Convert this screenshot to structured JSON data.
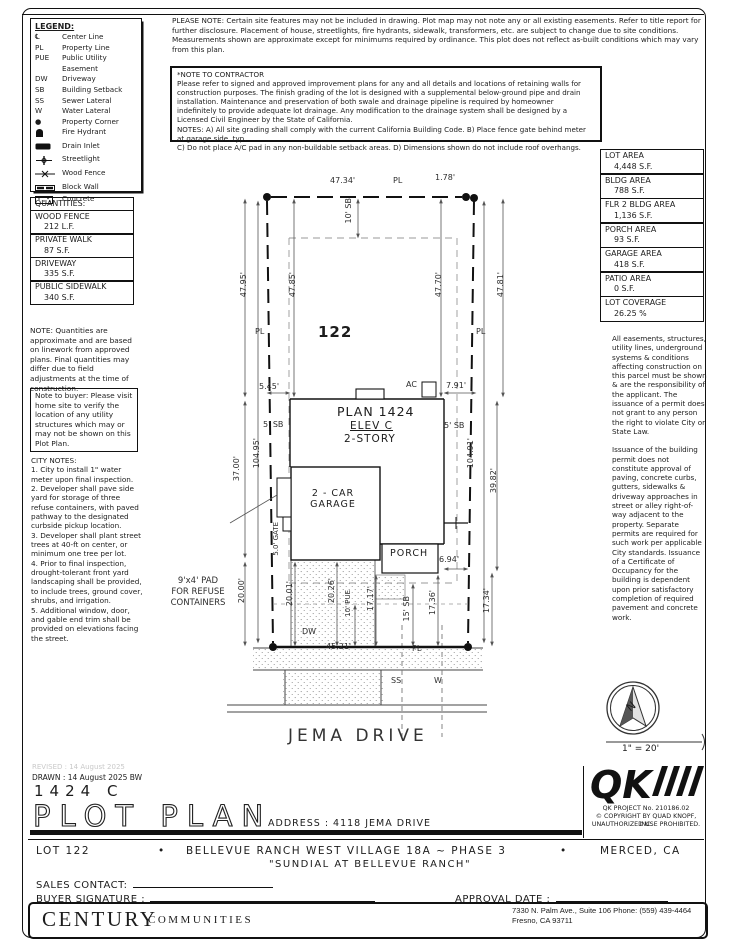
{
  "legend": {
    "title": "LEGEND:",
    "items": [
      {
        "sym": "℄",
        "label": "Center Line"
      },
      {
        "sym": "PL",
        "label": "Property Line"
      },
      {
        "sym": "PUE",
        "label": "Public Utility\nEasement"
      },
      {
        "sym": "DW",
        "label": "Driveway"
      },
      {
        "sym": "SB",
        "label": "Building Setback"
      },
      {
        "sym": "SS",
        "label": "Sewer Lateral"
      },
      {
        "sym": "W",
        "label": "Water Lateral"
      },
      {
        "sym": "●",
        "label": "Property Corner"
      },
      {
        "sym": "",
        "label": "Fire Hydrant"
      },
      {
        "sym": "",
        "label": "Drain Inlet"
      },
      {
        "sym": "",
        "label": "Streetlight"
      },
      {
        "sym": "",
        "label": "Wood Fence"
      },
      {
        "sym": "",
        "label": "Block Wall"
      },
      {
        "sym": "",
        "label": "Concrete"
      }
    ]
  },
  "notes": {
    "please_note": "PLEASE NOTE:  Certain site features may not be included in drawing. Plot map may not note any or all existing easements. Refer to title report for further disclosure. Placement of house, streetlights, fire hydrants, sidewalk, transformers, etc. are subject to change due to site conditions. Measurements shown are approximate except for minimums required by ordinance. This plot does not reflect as-built conditions which may vary from this plan.",
    "contractor_title": "*NOTE TO CONTRACTOR",
    "contractor_body": "Please refer to signed and approved improvement plans for any and all details and locations of retaining walls for construction purposes. The finish grading of the lot is designed with a supplemental below-ground pipe and drain installation. Maintenance and preservation of both swale and drainage pipeline is required by homeowner indefinitely to provide adequate lot drainage. Any modification to the drainage system shall be designed by a Licensed Civil Engineer by the State of California.",
    "contractor_notes": "NOTES:  A) All site grading shall comply with the current California Building Code.  B) Place fence gate behind meter at garage side, typ.\nC) Do not place A/C pad in any non-buildable setback areas.  D) Dimensions shown do not include roof overhangs."
  },
  "quantities": {
    "title": "QUANTITIES:",
    "rows": [
      {
        "name": "WOOD FENCE",
        "value": "212 L.F."
      },
      {
        "name": "PRIVATE WALK",
        "value": "87 S.F."
      },
      {
        "name": "DRIVEWAY",
        "value": "335 S.F."
      },
      {
        "name": "PUBLIC SIDEWALK",
        "value": "340 S.F."
      }
    ],
    "note": "NOTE: Quantities are approximate and are based on linework from approved plans.  Final quantities may differ due to field adjustments at the time of construction.",
    "buyer_note": "Note to buyer: Please visit home site to verify the location of any utility structures which may or may not be shown on this Plot Plan."
  },
  "areas": {
    "rows": [
      {
        "label": "LOT AREA",
        "value": "4,448 S.F."
      },
      {
        "label": "BLDG AREA",
        "value": "788 S.F."
      },
      {
        "label": "FLR 2 BLDG AREA",
        "value": "1,136 S.F."
      },
      {
        "label": "PORCH AREA",
        "value": "93 S.F."
      },
      {
        "label": "GARAGE AREA",
        "value": "418 S.F."
      },
      {
        "label": "PATIO AREA",
        "value": "0 S.F."
      },
      {
        "label": "LOT COVERAGE",
        "value": "26.25 %"
      }
    ]
  },
  "city_notes": {
    "title": "CITY NOTES:",
    "body": "1. City to install 1\" water meter upon final inspection.\n2. Developer shall pave side yard for storage of three refuse containers, with paved pathway to the designated curbside pickup location.\n3. Developer shall plant street trees at 40-ft on center, or minimum one tree per lot.\n4. Prior to final inspection, drought-tolerant front yard landscaping shall be provided, to include trees, ground cover, shrubs, and irrigation.\n5. Additional window, door, and gable end trim shall be provided on elevations facing the street."
  },
  "right_notes": {
    "para1": "All easements, structures, utility lines, underground systems & conditions affecting construction on this parcel must be shown & are the responsibility of the applicant. The issuance of a permit does not grant to any person the right to violate City or State Law.",
    "para2": "Issuance of the building permit does not constitute approval of paving, concrete curbs, gutters, sidewalks & driveway approaches in street or alley right-of-way adjacent to the property. Separate permits are required for such work per applicable City standards. Issuance of a Certificate of Occupancy for the building is dependent upon prior satisfactory completion of required pavement and concrete work."
  },
  "plan": {
    "lot_number": "122",
    "plan_name": "PLAN 1424",
    "elev": "ELEV C",
    "story": "2-STORY",
    "garage": "2 - CAR GARAGE",
    "porch": "PORCH",
    "refuse_pad": "9'x4' PAD\nFOR REFUSE\nCONTAINERS",
    "street": "JEMA DRIVE",
    "pl": "PL",
    "ac": "AC",
    "dw": "DW",
    "ss": "SS",
    "w": "W",
    "dims": {
      "top_width": "47.34'",
      "jog": "1.78'",
      "sb_top": "10' SB",
      "left_outer": "47.95'",
      "left_inner": "47.85'",
      "right_inner": "47.70'",
      "right_outer": "47.81'",
      "sb_side": "5' SB",
      "left_depth": "104.95'",
      "right_depth": "104.91'",
      "rear_left": "5.45'",
      "rear_right": "7.91'",
      "side_left": "37.00'",
      "right_mid": "39.82'",
      "gate": "5.0' GATE",
      "porch_side": "6.94'",
      "front_left": "20.00'",
      "drive_left": "20.01'",
      "drive_right": "20.26'",
      "pue": "10' PUE",
      "walk": "17.17'",
      "sb_front": "15' SB",
      "front_mid": "17.36'",
      "front_right": "17.34'",
      "frontage": "45.21'"
    }
  },
  "compass": {
    "north": "N",
    "scale": "1\" = 20'"
  },
  "qk": {
    "logo": "QK",
    "line1": "QK PROJECT No. 210186.02",
    "line2": "© COPYRIGHT BY QUAD KNOPF, INC.",
    "line3": "UNAUTHORIZED USE PROHIBITED."
  },
  "title_block": {
    "revised": "REVISED :  14 August 2025",
    "drawn": "DRAWN :  14 August 2025   BW",
    "plan_code": "1424  C",
    "title": "PLOT PLAN",
    "address": "ADDRESS :  4118 JEMA DRIVE"
  },
  "band": {
    "lot": "LOT 122",
    "bullet": "•",
    "community": "BELLEVUE RANCH WEST VILLAGE 18A ~ PHASE 3",
    "city": "MERCED, CA",
    "subtitle": "\"SUNDIAL AT BELLEVUE RANCH\"",
    "sales_contact": "SALES CONTACT:",
    "buyer_signature": "BUYER SIGNATURE :",
    "approval_date": "APPROVAL DATE :"
  },
  "footer": {
    "brand1": "CENTURY",
    "brand2": "COMMUNITIES",
    "addr1": "7330 N. Palm Ave., Suite 106    Phone:  (559) 439-4464",
    "addr2": "Fresno, CA  93711"
  }
}
